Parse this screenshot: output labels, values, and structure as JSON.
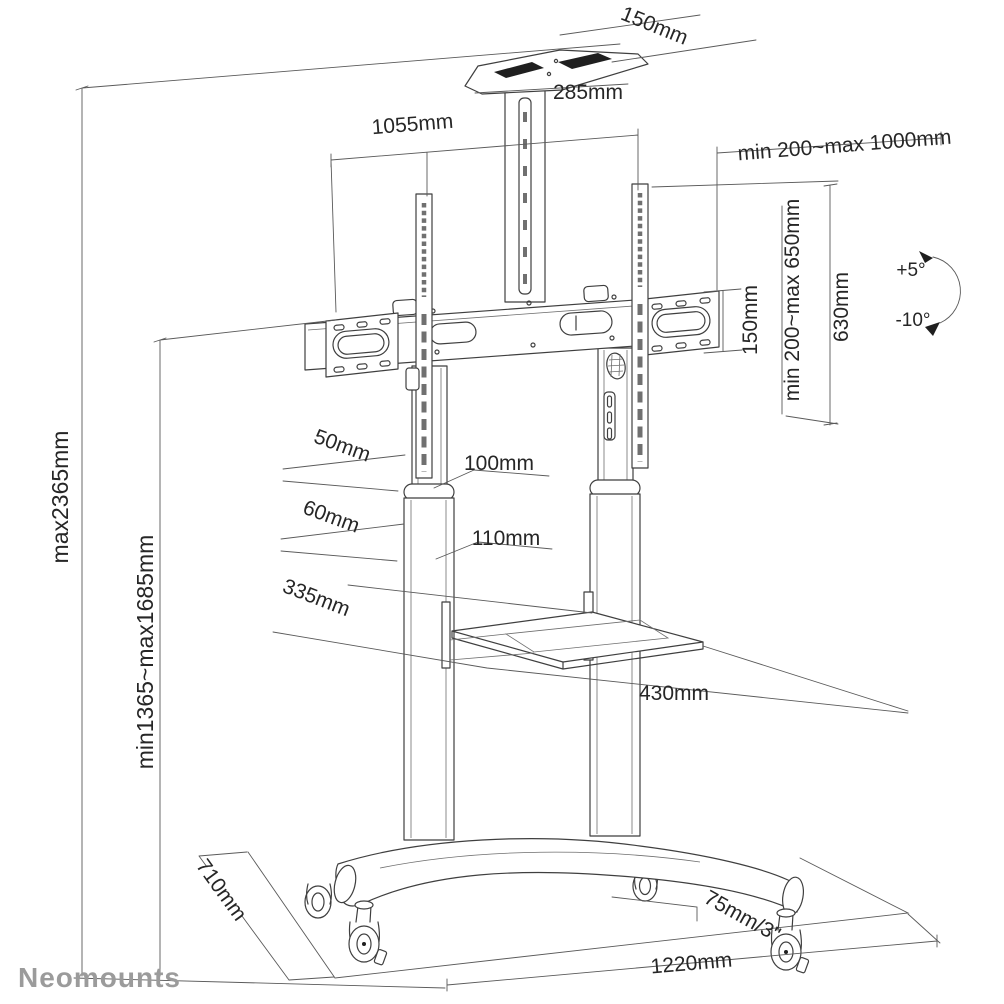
{
  "page": {
    "background": "#ffffff",
    "line_color": "#3f3f3f",
    "dimension_line_color": "#5a5a5a",
    "label_color": "#262626",
    "logo_color": "#9b9b9b",
    "description": "Technical dimension diagram of a Neomounts mobile TV floor stand with camera shelf, AV shelf and casters"
  },
  "dimensions": {
    "top_shelf_depth": "150mm",
    "top_shelf_width": "285mm",
    "crossbar_width": "1055mm",
    "vesa_width_range": "min 200~max 1000mm",
    "vesa_plate_height": "150mm",
    "vesa_height_range": "min 200~max 650mm",
    "bracket_rail_height": "630mm",
    "tilt_up": "+5°",
    "tilt_down": "-10°",
    "max_total_height": "max2365mm",
    "screen_center_height_range": "min1365~max1685mm",
    "upper_column_width": "50mm",
    "upper_column_depth": "100mm",
    "lower_column_width": "60mm",
    "lower_column_depth": "110mm",
    "av_shelf_depth": "335mm",
    "av_shelf_width": "430mm",
    "base_depth": "710mm",
    "caster_size": "75mm/3\"",
    "base_width": "1220mm"
  },
  "logo": {
    "text": "Neomounts"
  }
}
